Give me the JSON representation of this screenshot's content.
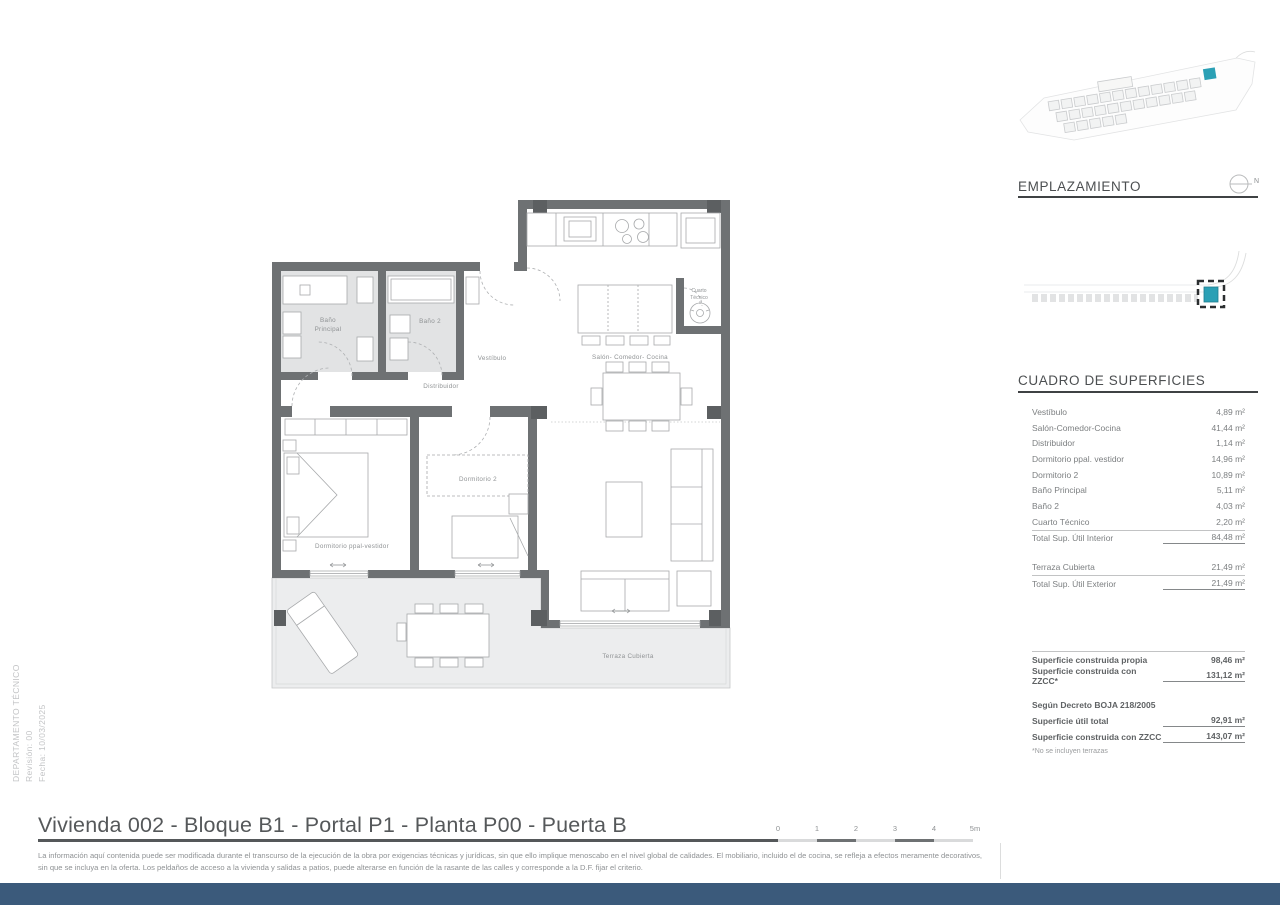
{
  "sidebar": {
    "department": "DEPARTAMENTO TÉCNICO",
    "revision": "Revisión: 00",
    "date": "Fecha: 10/03/2025"
  },
  "emplazamiento": {
    "title": "EMPLAZAMIENTO",
    "north_label": "N"
  },
  "surfaces": {
    "title": "CUADRO DE SUPERFICIES",
    "interior_rows": [
      {
        "label": "Vestíbulo",
        "value": "4,89 m²"
      },
      {
        "label": "Salón-Comedor-Cocina",
        "value": "41,44 m²"
      },
      {
        "label": "Distribuidor",
        "value": "1,14 m²"
      },
      {
        "label": "Dormitorio ppal. vestidor",
        "value": "14,96 m²"
      },
      {
        "label": "Dormitorio 2",
        "value": "10,89 m²"
      },
      {
        "label": "Baño Principal",
        "value": "5,11 m²"
      },
      {
        "label": "Baño 2",
        "value": "4,03 m²"
      },
      {
        "label": "Cuarto Técnico",
        "value": "2,20 m²"
      }
    ],
    "interior_total": {
      "label": "Total Sup. Útil Interior",
      "value": "84,48 m²"
    },
    "exterior_row": {
      "label": "Terraza Cubierta",
      "value": "21,49 m²"
    },
    "exterior_total": {
      "label": "Total Sup. Útil Exterior",
      "value": "21,49 m²"
    },
    "built": [
      {
        "label": "Superficie construida propia",
        "value": "98,46 m²"
      },
      {
        "label": "Superficie construida con ZZCC*",
        "value": "131,12 m²"
      }
    ],
    "decree_header": "Según Decreto BOJA 218/2005",
    "decree_rows": [
      {
        "label": "Superficie útil total",
        "value": "92,91 m²"
      },
      {
        "label": "Superficie construida con ZZCC",
        "value": "143,07 m²"
      }
    ],
    "footnote": "*No se incluyen terrazas"
  },
  "plan": {
    "bano_ppal_1": "Baño",
    "bano_ppal_2": "Principal",
    "bano2": "Baño 2",
    "vestibulo": "Vestíbulo",
    "salon": "Salón- Comedor- Cocina",
    "distribuidor": "Distribuidor",
    "cuarto_1": "Cuarto",
    "cuarto_2": "Técnico",
    "dorm2": "Dormitorio 2",
    "dorm_ppal": "Dormitorio ppal-vestidor",
    "terraza": "Terraza Cubierta"
  },
  "footer": {
    "title": "Vivienda 002 - Bloque B1 - Portal P1 - Planta P00 - Puerta B",
    "scale_labels": [
      "0",
      "1",
      "2",
      "3",
      "4",
      "5m"
    ],
    "disclaimer": "La información aquí contenida puede ser modificada durante el transcurso de la ejecución de la obra por exigencias técnicas y jurídicas, sin que ello implique menoscabo en el nivel global de calidades. El mobiliario, incluido el de cocina, se refleja a efectos meramente decorativos, sin que se incluya en la oferta. Los peldaños de acceso a la vivienda y salidas a patios, puede alterarse en función de la rasante de las calles y corresponde a la D.F. fijar el criterio."
  },
  "colors": {
    "accent_teal": "#2ba0b5",
    "wall_gray": "#6e7173",
    "footer_bar": "#3b5a7b"
  }
}
